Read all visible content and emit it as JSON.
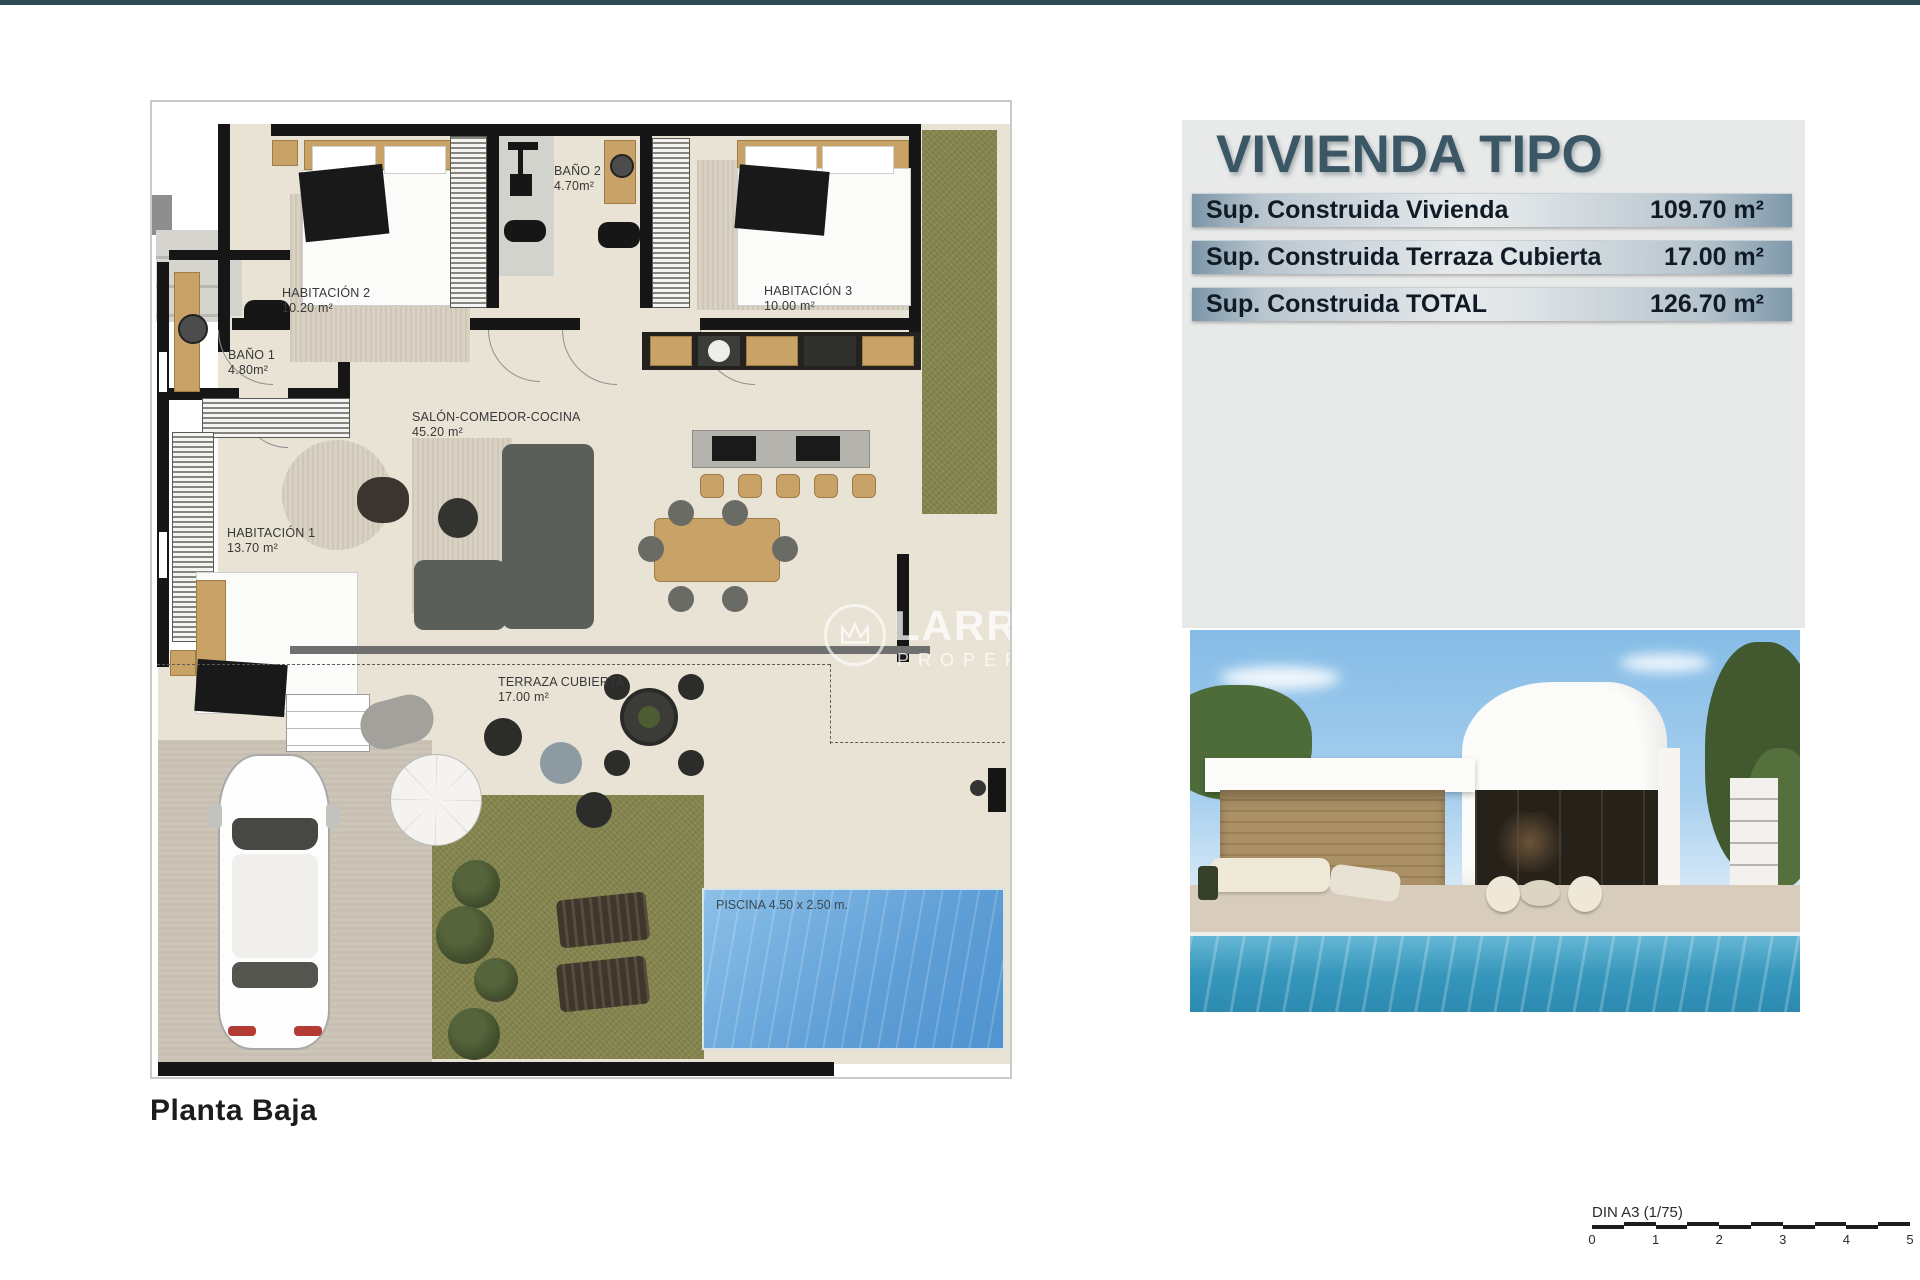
{
  "plan": {
    "floor_label": "Planta Baja",
    "rooms": [
      {
        "name": "HABITACIÓN 2",
        "area": "10.20 m²"
      },
      {
        "name": "BAÑO 2",
        "area": "4.70m²"
      },
      {
        "name": "HABITACIÓN 3",
        "area": "10.00 m²"
      },
      {
        "name": "BAÑO 1",
        "area": "4.80m²"
      },
      {
        "name": "SALÓN-COMEDOR-COCINA",
        "area": "45.20 m²"
      },
      {
        "name": "HABITACIÓN 1",
        "area": "13.70 m²"
      },
      {
        "name": "TERRAZA CUBIERTA",
        "area": "17.00 m²"
      }
    ],
    "pool_label": "PISCINA 4.50 x 2.50 m.",
    "watermark": {
      "brand": "LARROSA",
      "subtitle": "PROPERTIES"
    }
  },
  "info_panel": {
    "title": "VIVIENDA TIPO",
    "rows": [
      {
        "label": "Sup. Construida Vivienda",
        "value": "109.70 m²"
      },
      {
        "label": "Sup. Construida Terraza Cubierta",
        "value": "17.00 m²"
      },
      {
        "label": "Sup. Construida TOTAL",
        "value": "126.70 m²"
      }
    ]
  },
  "scale_bar": {
    "label": "DIN A3 (1/75)",
    "ticks": [
      "0",
      "1",
      "2",
      "3",
      "4",
      "5"
    ]
  },
  "colors": {
    "top_bar": "#2e4c57",
    "accent": "#3b5765",
    "grass": "#83834c",
    "pool": "#5e9ed6",
    "floor": "#e9e3d5"
  }
}
